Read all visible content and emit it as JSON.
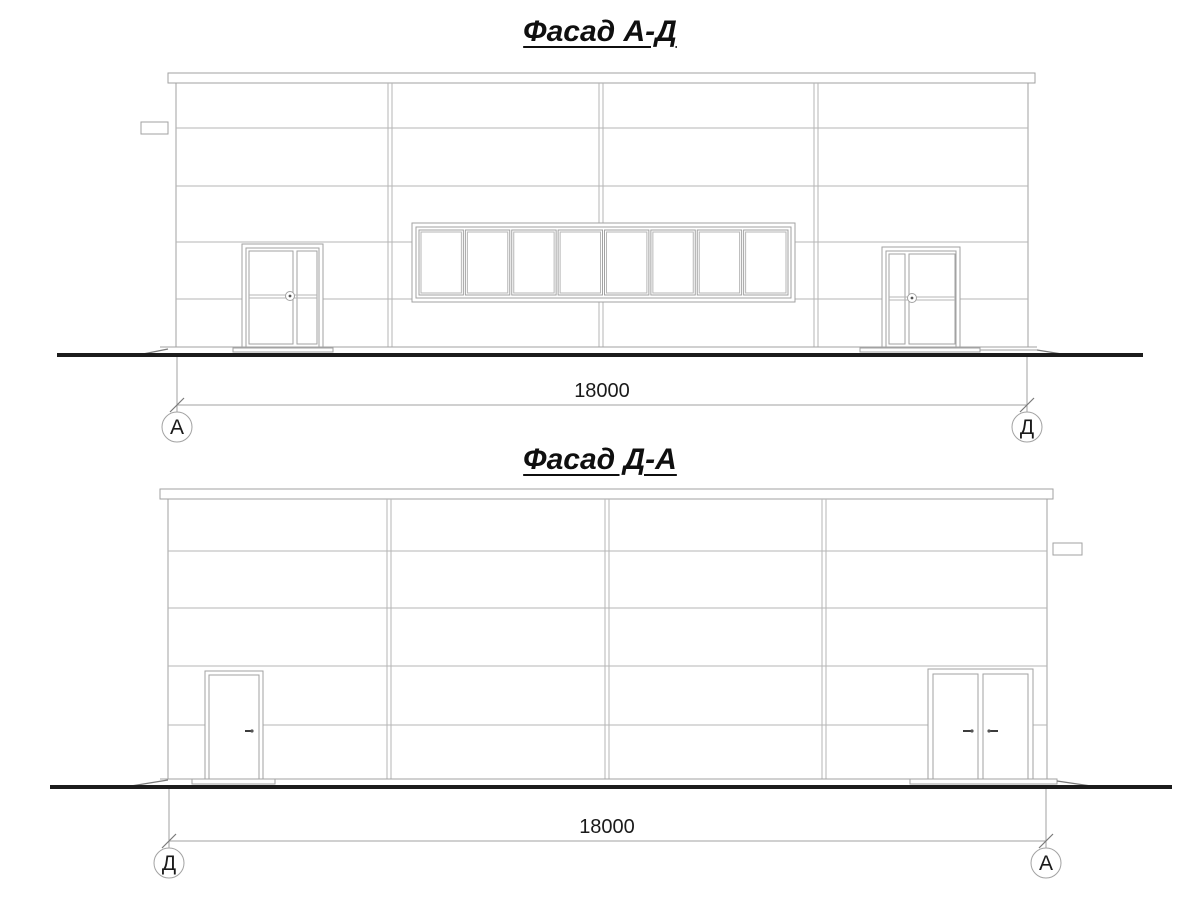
{
  "colors": {
    "line": "#a2a2a2",
    "line_light": "#b6b6b6",
    "ground": "#1c1c1c",
    "text": "#1a1a1a",
    "tick": "#7a7a7a"
  },
  "drawings": [
    {
      "title": "Фасад А-Д",
      "dimension_value": "18000",
      "axis_left": "А",
      "axis_right": "Д",
      "window_band": {
        "panes": 8
      }
    },
    {
      "title": "Фасад Д-А",
      "dimension_value": "18000",
      "axis_left": "Д",
      "axis_right": "А"
    }
  ]
}
